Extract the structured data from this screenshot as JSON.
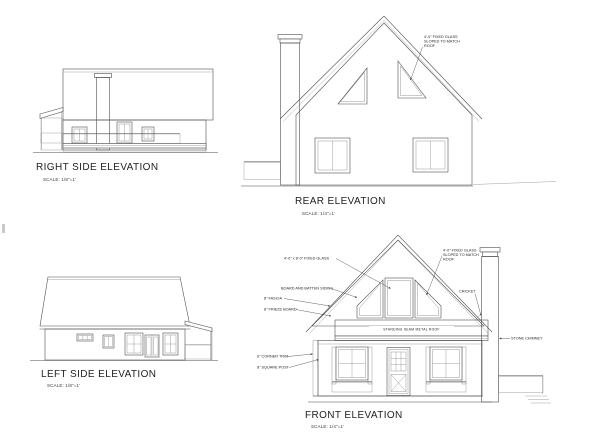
{
  "sheet": {
    "background": "#ffffff",
    "ink_color": "#1f1f1f",
    "line_color": "#4f4f4f"
  },
  "elevations": {
    "right_side": {
      "title": "RIGHT SIDE ELEVATION",
      "scale": "SCALE: 1/8\"=1'"
    },
    "rear": {
      "title": "REAR ELEVATION",
      "scale": "SCALE: 1/4\"=1'",
      "annotations": {
        "sloped_glass": "4'-0\" FIXED GLASS\nSLOPED TO MATCH\nROOF"
      }
    },
    "left_side": {
      "title": "LEFT SIDE ELEVATION",
      "scale": "SCALE: 1/8\"=1'"
    },
    "front": {
      "title": "FRONT ELEVATION",
      "scale": "SCALE: 1/4\"=1'",
      "annotations": {
        "fixed_glass": "4'-0\" x 8'-0\" FIXED GLASS",
        "board_and_batten": "BOARD AND BATTEN SIDING",
        "fascia": "8\" FASCIA",
        "frieze_board": "8\" FRIEZE BOARD",
        "corner_trim": "6\" CORNER TRIM",
        "square_post": "8\" SQUARE POST",
        "sloped_glass": "4'-0\" FIXED GLASS\nSLOPED TO MATCH\nROOF",
        "cricket": "CRICKET",
        "stone_chimney": "STONE CHIMNEY",
        "metal_roof": "STANDING SEAM METAL ROOF"
      }
    }
  }
}
